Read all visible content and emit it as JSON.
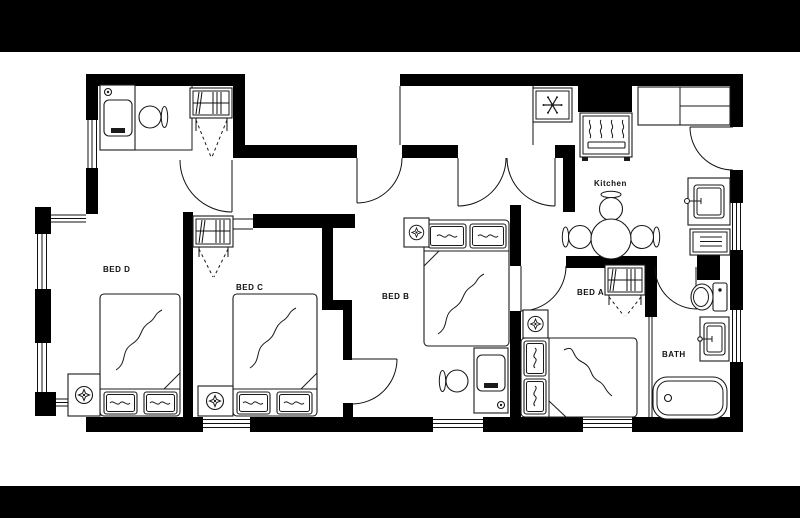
{
  "page": {
    "background": "#ffffff",
    "banner_color": "#000000",
    "wall_color": "#000000",
    "line_color": "#111111",
    "plan_type": "apartment-floor-plan"
  },
  "rooms": {
    "bed_d": {
      "label": "BED D",
      "furniture": [
        "double-bed",
        "two-pillows",
        "bedside-lamp-table",
        "desk",
        "desk-chair",
        "wardrobe-closet"
      ]
    },
    "bed_c": {
      "label": "BED C",
      "furniture": [
        "double-bed",
        "two-pillows",
        "bedside-lamp-table",
        "wardrobe-closet"
      ]
    },
    "bed_b": {
      "label": "BED B",
      "furniture": [
        "double-bed",
        "two-pillows",
        "bedside-lamp-table",
        "desk",
        "desk-chair"
      ]
    },
    "bed_a": {
      "label": "BED A",
      "furniture": [
        "double-bed",
        "two-pillows",
        "bedside-lamp-table",
        "wardrobe-closet"
      ]
    },
    "kitchen": {
      "label": "Kitchen",
      "furniture": [
        "refrigerator",
        "stove-oven",
        "kitchen-counter",
        "dining-table",
        "dining-chairs",
        "kitchen-sink",
        "dishwasher"
      ]
    },
    "bath": {
      "label": "BATH",
      "furniture": [
        "toilet",
        "bathroom-sink",
        "bathtub"
      ]
    }
  },
  "openings": {
    "doors": [
      "bed-d-door",
      "entrance-door",
      "hall-double-door",
      "kitchen-side-door",
      "bed-b-door",
      "bed-a-door",
      "bath-door",
      "closet-bifold-doors"
    ],
    "window_segments": 10
  }
}
